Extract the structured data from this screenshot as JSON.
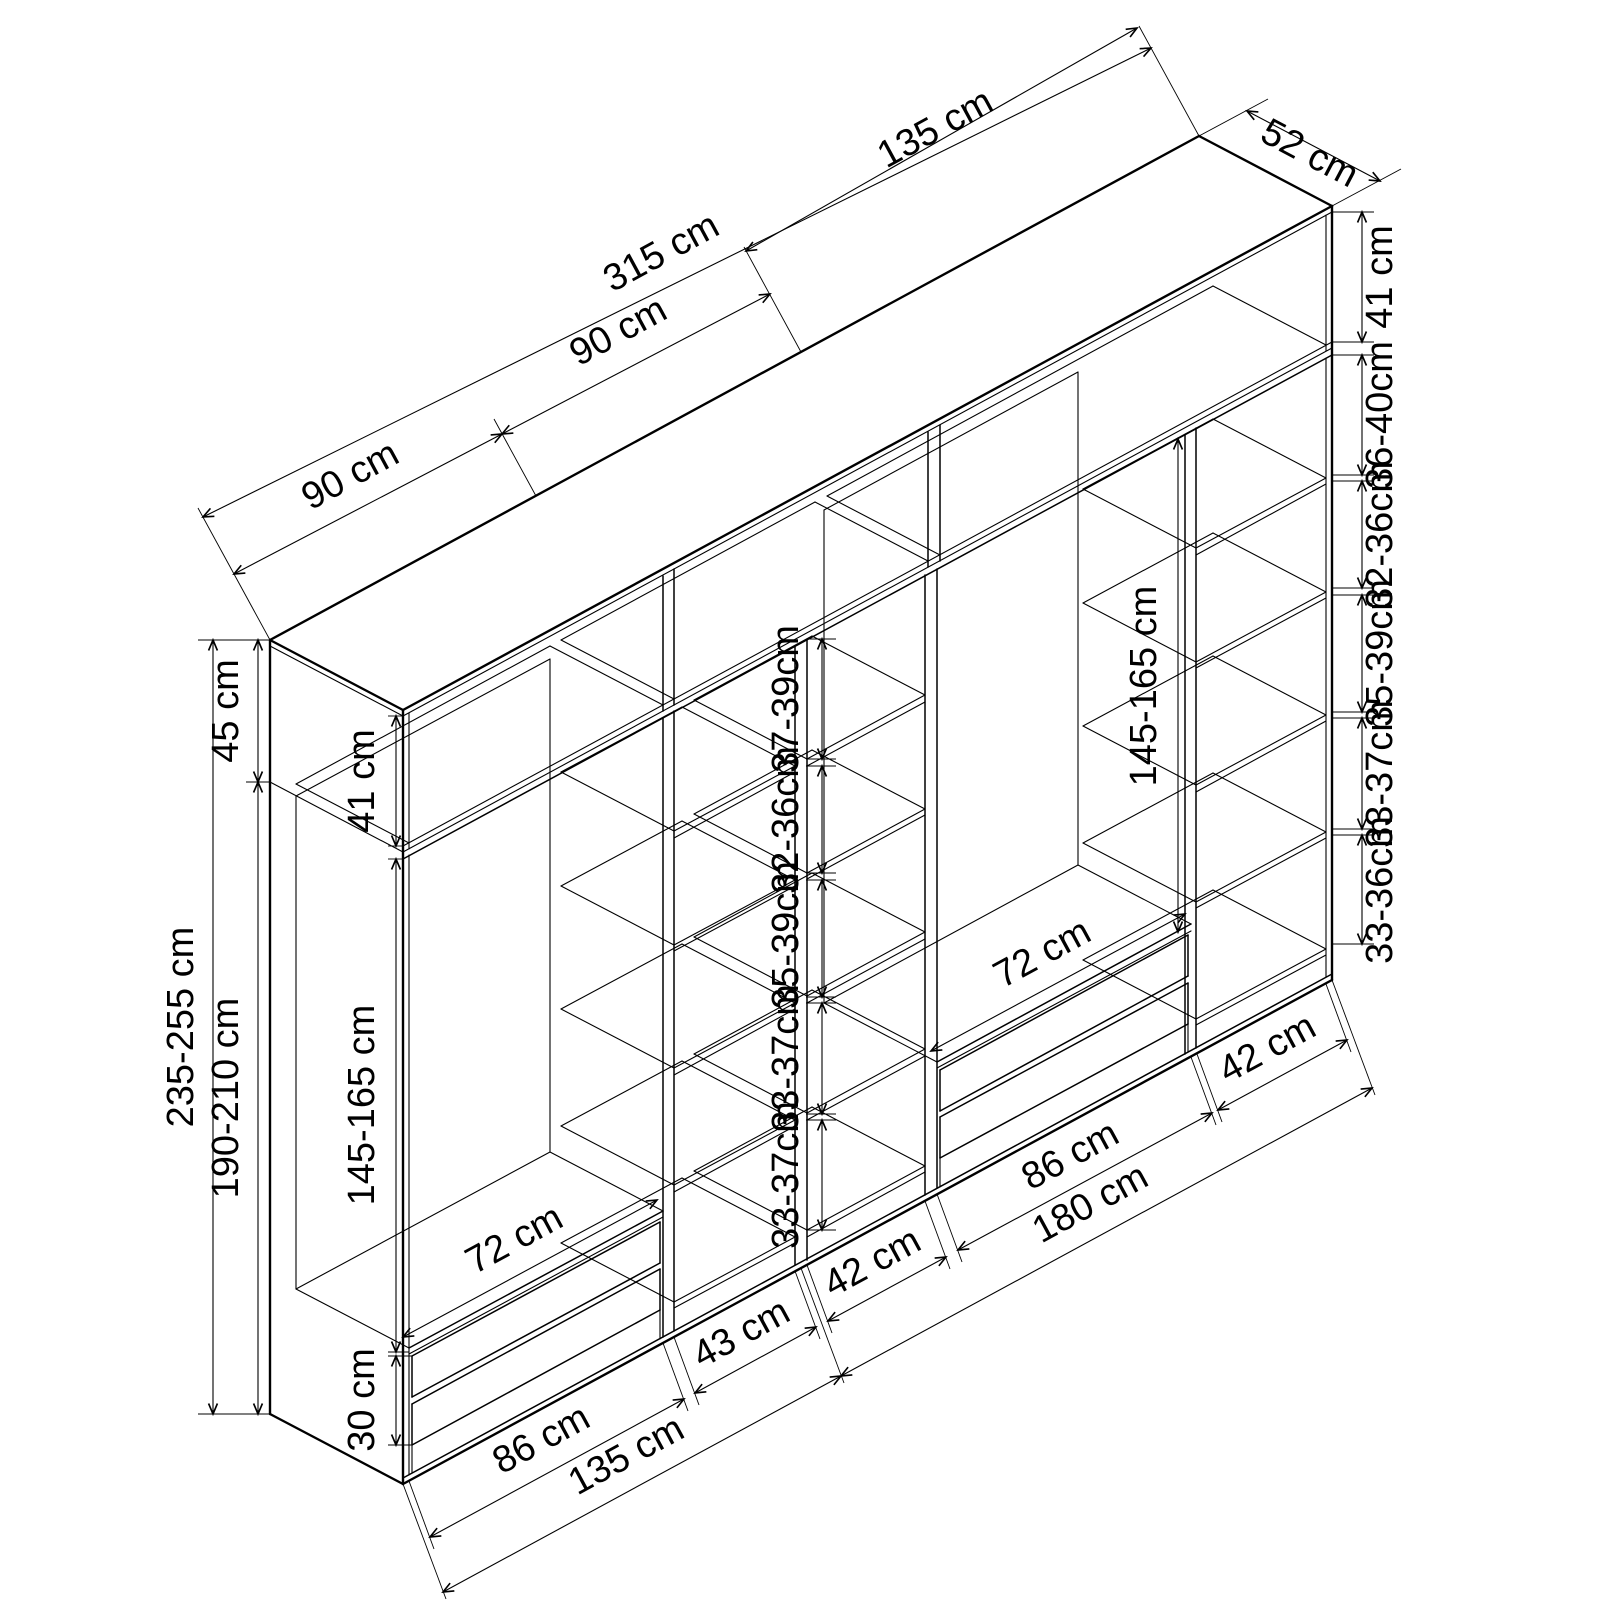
{
  "drawing": {
    "kind": "isometric wardrobe dimension diagram",
    "background_color": "#ffffff",
    "line_color": "#000000",
    "unit": "cm"
  },
  "dims": {
    "top": {
      "module_left": "90 cm",
      "module_mid": "90 cm",
      "total_width": "315 cm",
      "module_right": "135 cm",
      "depth": "52 cm"
    },
    "left": {
      "top_box_height": "45 cm",
      "total_height": "235-255 cm",
      "carcass_height": "190-210 cm",
      "top_box_interior": "41 cm",
      "hanging_height": "145-165 cm",
      "drawer_stack_height": "30 cm",
      "drawer_width": "72 cm",
      "wardrobe_width": "86 cm",
      "shelf_column_width": "43 cm",
      "section_width": "135 cm"
    },
    "center_gaps": [
      "37-39cm",
      "32-36cm",
      "35-39cm",
      "33-37cm",
      "33-37cm"
    ],
    "right": {
      "top_box_interior": "41 cm",
      "shelf_gaps": [
        "36-40cm",
        "32-36cm",
        "35-39cm",
        "33-37cm",
        "33-36cm"
      ],
      "hanging_height": "145-165 cm",
      "drawer_width": "72 cm",
      "left_column_width": "42 cm",
      "wardrobe_width": "86 cm",
      "section_width": "180 cm",
      "right_column_width": "42 cm"
    }
  }
}
